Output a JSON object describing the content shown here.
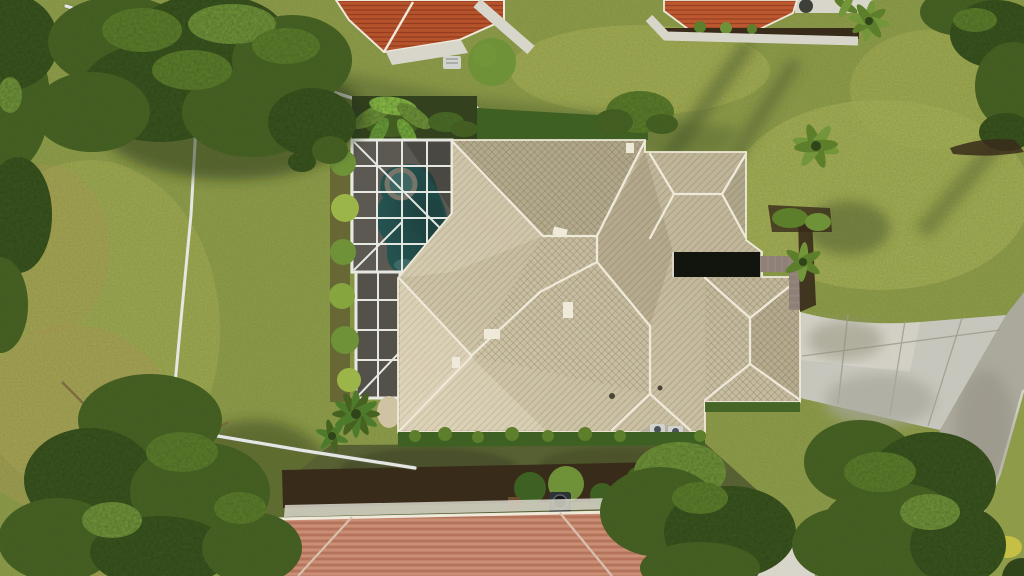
{
  "scene": {
    "description": "Aerial drone photo looking straight down at a tan-tile-roof home with a screened swimming-pool enclosure, curved concrete driveway to a street, surrounding lawns, large oak trees, a white fence, and neighboring orange- and salmon-tile-roof houses.",
    "objects": [
      "main-house-hip-roof",
      "entry-courtyard",
      "screened-pool-enclosure",
      "swimming-pool",
      "spa",
      "pool-deck",
      "banana-plants",
      "foundation-bushes",
      "sago-palm",
      "privacy-fence",
      "left-field",
      "oak-tree-north",
      "oak-tree-south",
      "shade-trees-south",
      "driveway",
      "paver-walkway",
      "street",
      "curb",
      "neighbor-house-northwest",
      "neighbor-house-north",
      "neighbor-house-south",
      "palm-trees",
      "mulch-beds",
      "hedge-row",
      "ac-units",
      "lawn-shadows",
      "pool-equipment"
    ]
  },
  "colors": {
    "grass-base": "#8e9c4a",
    "grass-light": "#a9b257",
    "grass-shade": "#5d6e33",
    "grass-dark": "#566032",
    "field-tan": "#b09c58",
    "tree-dark": "#2f4419",
    "tree-mid": "#466120",
    "tree-light": "#5d7e2b",
    "tree-glow": "#73963a",
    "branch-brown": "#7a6840",
    "roof-tan": "#c9bea1",
    "roof-light": "#ddd3b7",
    "roof-shade": "#a89d81",
    "ridge-white": "#efe9d9",
    "roof-red": "#b4532c",
    "roof-orange": "#bb5830",
    "roof-salmon": "#c28269",
    "concrete": "#d8d6ca",
    "driveway": "#c6c6bc",
    "driveway-shade": "#a8a79b",
    "road": "#aba89c",
    "curb": "#d3d1c7",
    "paver": "#8e8077",
    "mulch": "#382b1a",
    "hedge": "#3f6023",
    "bush-green": "#6f9238",
    "pool-water": "#2f827e",
    "pool-deep": "#1e5c5b",
    "pool-light": "#66aea9",
    "spa-water": "#579a95",
    "pool-deck": "#8b8379",
    "screen-dark": "#1d1f1d",
    "cage-frame": "#eef0ea",
    "fence-white": "#e4e7e2",
    "sand": "#cfc3a4",
    "ac-gray": "#d0d3ce",
    "shadow-olive": "#46552a"
  }
}
